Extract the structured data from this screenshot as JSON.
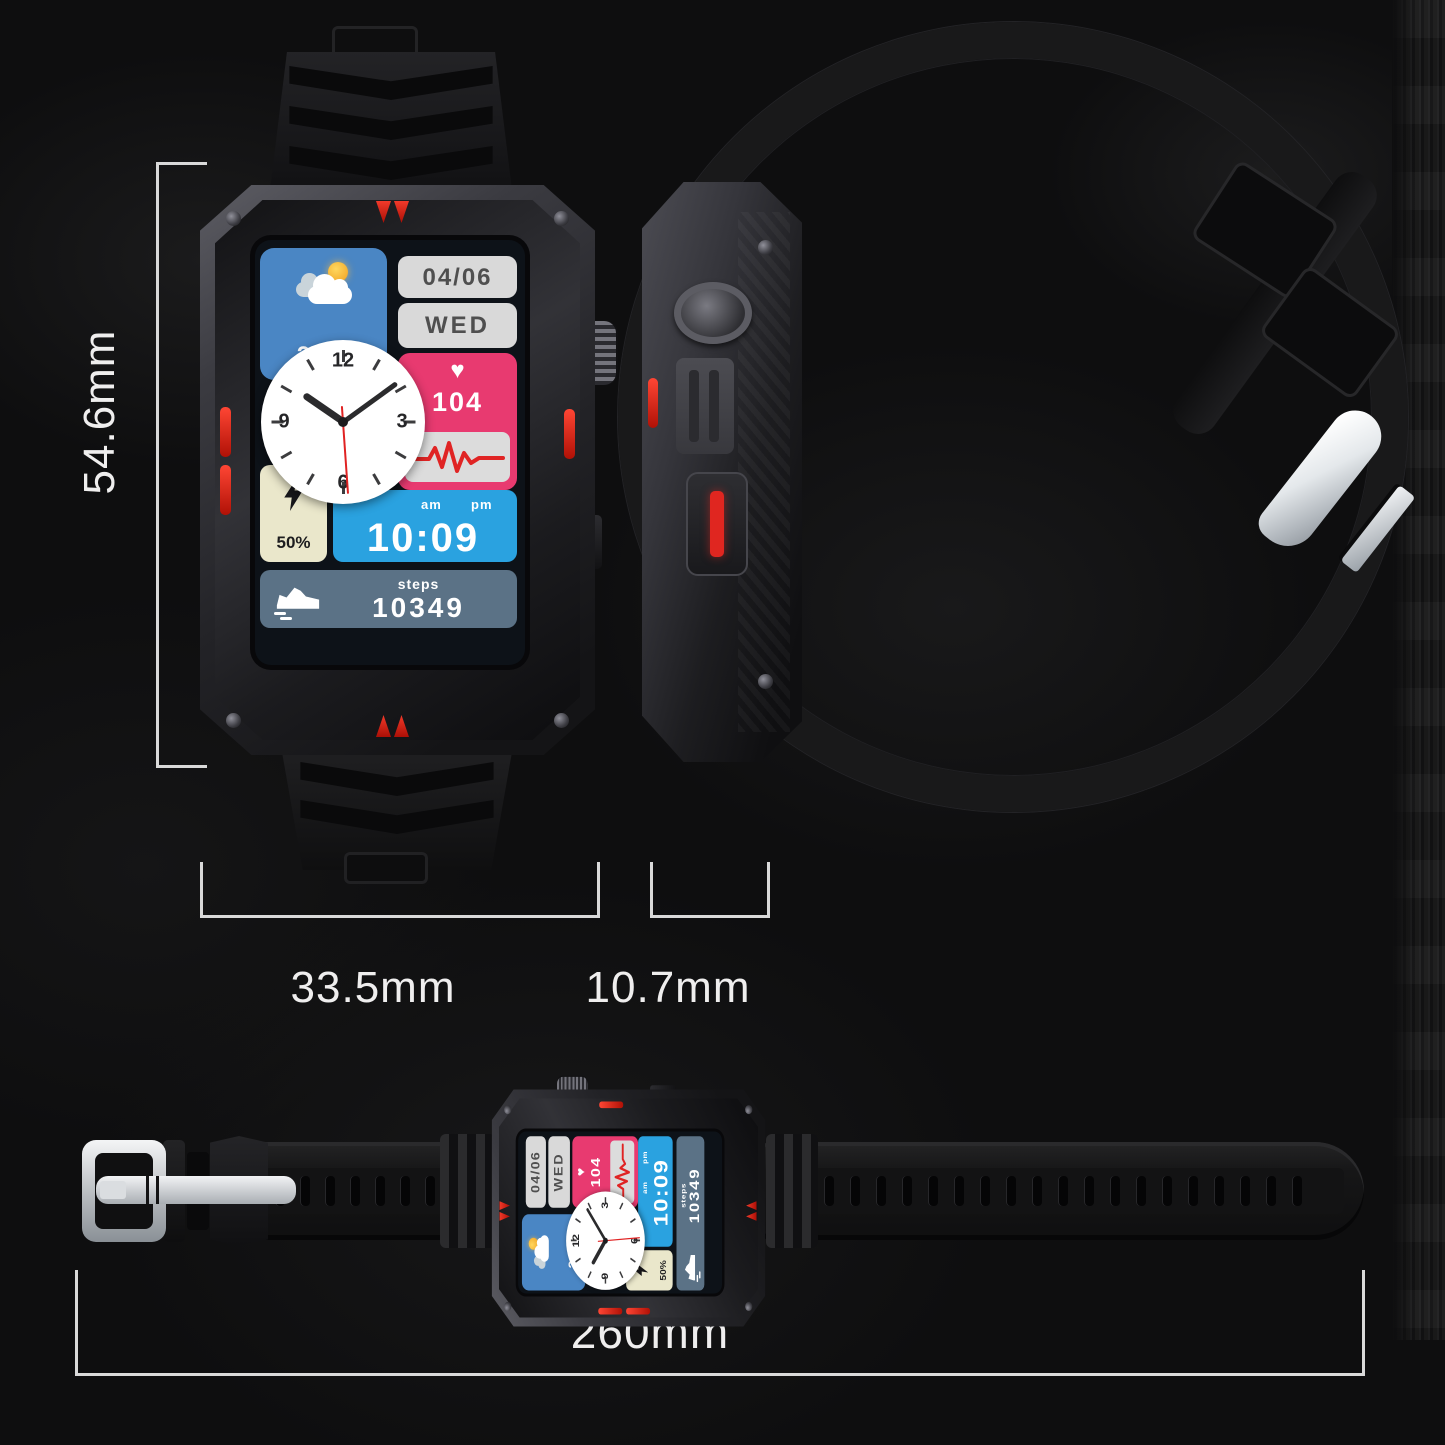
{
  "dimensions": {
    "height": "54.6mm",
    "case_width": "33.5mm",
    "thickness": "10.7mm",
    "strap_length": "260mm"
  },
  "watch_face": {
    "weather": {
      "temperature": "24°C",
      "icon": "sun-cloud-icon"
    },
    "date": "04/06",
    "weekday": "WED",
    "heart_rate": {
      "value": "104",
      "icon": "heart-icon",
      "heart_glyph": "♥"
    },
    "battery": {
      "value": "50%",
      "icon": "lightning-icon"
    },
    "clock": {
      "numeral_12": "12",
      "numeral_3": "3",
      "numeral_6": "6",
      "numeral_9": "9",
      "hour_angle_deg": 304.5,
      "minute_angle_deg": 54,
      "second_angle_deg": 176
    },
    "digital_time": {
      "am": "am",
      "pm": "pm",
      "value": "10:09"
    },
    "steps": {
      "label": "steps",
      "value": "10349",
      "icon": "shoe-icon"
    }
  },
  "colors": {
    "accent_red": "#d32018",
    "tile_blue": "#4a86c4",
    "tile_sky": "#2aa2e0",
    "tile_pink": "#e83a70",
    "tile_grey": "#d9d9d9",
    "tile_cream": "#eae7cb",
    "tile_slate": "#5b7286",
    "dim_line": "#d9d9d9"
  }
}
